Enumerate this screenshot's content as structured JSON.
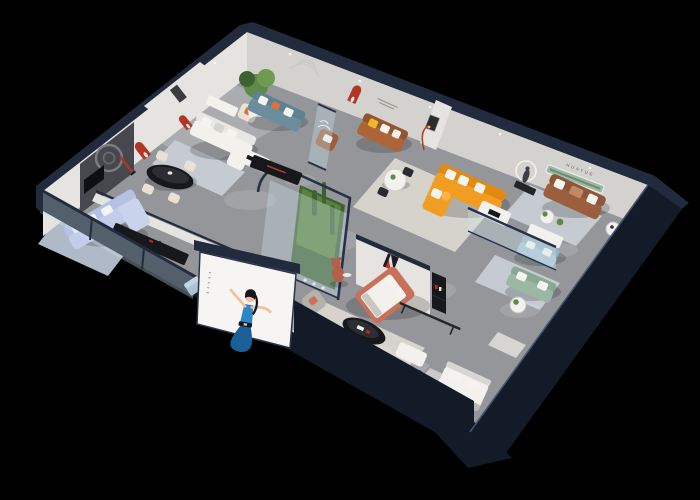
{
  "scene": {
    "type": "3d-isometric-cutaway-render",
    "description": "Photorealistic axonometric cutaway render of a furniture brand showroom apartment, viewed from above on a solid black background. Dark navy exterior shell walls, white interior walls with red arched niches, multiple furnished room vignettes and ceiling spotlights.",
    "background_color": "#000000"
  },
  "brand": {
    "logo_monogram": "H",
    "logo_name_cn": "华悦",
    "wall_lettering": "HUAYUE"
  },
  "colors": {
    "navy": "#222b3d",
    "navyDeep": "#131a28",
    "navyEdge": "#46536e",
    "wall": "#e6e4e0",
    "wallShade": "#d4d2ce",
    "floor": "#94969a",
    "floorLight": "#b2b3b5",
    "rug": "#d6d3cc",
    "rugCool": "#c5cbd1",
    "black": "#17181c",
    "charcoal": "#47484d",
    "red": "#b23527",
    "brandRed": "#d42313",
    "orange": "#f09d22",
    "teal": "#5d8292",
    "periwinkle": "#b4c1e3",
    "brown": "#9c5f3e",
    "sage": "#9cb7a4",
    "lightblue": "#a9c3d5",
    "salmon": "#c9705a",
    "green": "#5e8a45",
    "greenDark": "#3e6132",
    "white": "#f2f1ee",
    "cream": "#e9e2d4",
    "grayFurn": "#b5b2ac",
    "yellow": "#f2b52a",
    "pillowOrange": "#df7040",
    "bear": "#b2604a",
    "glass": "#cfe4ea",
    "skin": "#f0c09d",
    "dress": "#2b87c8",
    "dressDark": "#1a5f96",
    "hair": "#15161a"
  },
  "inventory": {
    "rooms": [
      {
        "name": "dining-room",
        "items": [
          "black-oval-dining-table",
          "cream-dining-chairs",
          "charcoal-feature-wall",
          "ring-artwork",
          "red-arched-niches",
          "red-floor-lamp",
          "white-sideboard"
        ]
      },
      {
        "name": "left-lounge",
        "items": [
          "periwinkle-sectional-sofa",
          "black-media-console",
          "black-coffee-table",
          "striped-rug"
        ]
      },
      {
        "name": "white-lounge",
        "items": [
          "white-sectional-sofa",
          "white-coffee-table",
          "black-tv-console",
          "cream-armchair",
          "potted-tree"
        ]
      },
      {
        "name": "teal-lounge",
        "items": [
          "teal-sofa",
          "glass-partition",
          "arc-wall-decor"
        ]
      },
      {
        "name": "center-lounge",
        "items": [
          "brown-loveseat",
          "yellow-pillow",
          "round-dining-table",
          "brown-armchair",
          "wall-quote"
        ]
      },
      {
        "name": "orange-lounge",
        "items": [
          "orange-l-shaped-sofa",
          "white-coffee-table",
          "framed-art-stub-wall",
          "red-arc-lamp",
          "runner-sculpture"
        ]
      },
      {
        "name": "right-lounge",
        "items": [
          "brown-three-seat-sofa",
          "round-side-tables",
          "green-display-shelf",
          "wall-lettering-huayue"
        ]
      },
      {
        "name": "glass-atrium",
        "items": [
          "cacti",
          "planting-bed",
          "bear-sculpture"
        ]
      },
      {
        "name": "master-bedroom",
        "items": [
          "salmon-framed-bed",
          "black-oval-coffee-table",
          "white-ottoman",
          "gray-armchair",
          "brand-logo-wall",
          "black-display-shelf",
          "display-rail"
        ]
      },
      {
        "name": "glass-lounge",
        "items": [
          "light-blue-sofa",
          "sage-green-sofa",
          "white-console",
          "round-side-table"
        ]
      },
      {
        "name": "back-bedroom",
        "items": [
          "white-bed",
          "wardrobe"
        ]
      },
      {
        "name": "storefront",
        "items": [
          "hostess-billboard",
          "glass-facade",
          "blue-ottoman-cube"
        ]
      }
    ]
  }
}
